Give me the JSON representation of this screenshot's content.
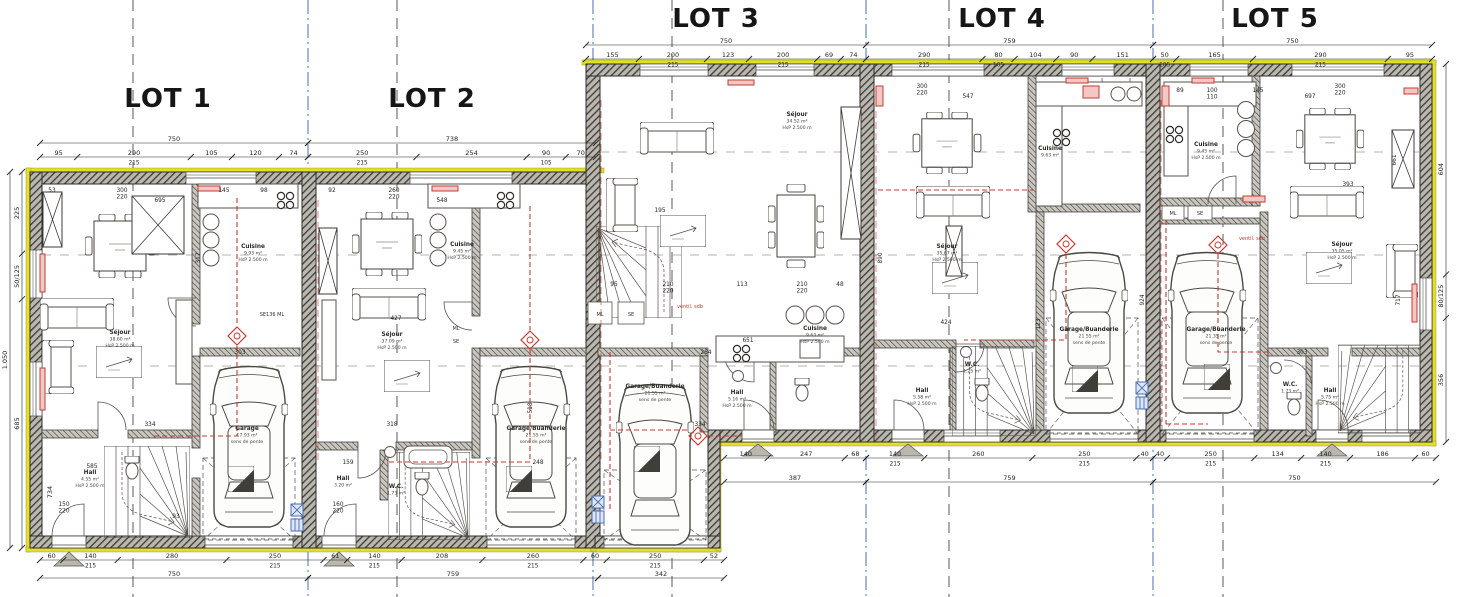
{
  "lot_titles": [
    "LOT 1",
    "LOT 2",
    "LOT 3",
    "LOT 4",
    "LOT 5"
  ],
  "rooms": {
    "l1_sejour": [
      "Séjour",
      "38.60 m²",
      "HsP 2.500 m"
    ],
    "l1_cuisine": [
      "Cuisine",
      "9.93 m²",
      "HsP 2.500 m"
    ],
    "l1_garage": [
      "Garage",
      "17.93 m²",
      "sens de pente"
    ],
    "l1_hall": [
      "Hall",
      "4.55 m²",
      "HsP 2.500 m"
    ],
    "l2_sejour": [
      "Séjour",
      "37.09 m²",
      "HsP 2.500 m"
    ],
    "l2_cuisine": [
      "Cuisine",
      "9.45 m²",
      "HsP 2.500 m"
    ],
    "l2_garage": [
      "Garage/Buanderie",
      "21.55 m²",
      "sens de pente"
    ],
    "l2_hall": [
      "Hall",
      "3.20 m²"
    ],
    "l2_wc": [
      "W.C.",
      "1.73 m²"
    ],
    "l3_sejour": [
      "Séjour",
      "34.52 m²",
      "HsP 2.500 m"
    ],
    "l3_cuisine": [
      "Cuisine",
      "9.63 m²",
      "HsP 2.500 m"
    ],
    "l3_garage": [
      "Garage/Buanderie",
      "21.55 m²",
      "sens de pente"
    ],
    "l3_hall": [
      "Hall",
      "5.16 m²",
      "HsP 2.500 m"
    ],
    "l4_sejour": [
      "Séjour",
      "35.67 m²",
      "HsP 2.500 m"
    ],
    "l4_cuisine": [
      "Cuisine",
      "9.63 m²"
    ],
    "l4_garage": [
      "Garage/Buanderie",
      "21.55 m²",
      "sens de pente"
    ],
    "l4_hall": [
      "Hall",
      "5.58 m²",
      "HsP 2.500 m"
    ],
    "l4_wc": [
      "W.C.",
      "1.25 m²"
    ],
    "l5_sejour": [
      "Séjour",
      "35.05 m²",
      "HsP 2.500 m"
    ],
    "l5_cuisine": [
      "Cuisine",
      "9.45 m²",
      "HsP 2.500 m"
    ],
    "l5_garage": [
      "Garage/Buanderie",
      "21.35 m²",
      "sens de pente"
    ],
    "l5_hall": [
      "Hall",
      "5.75 m²",
      "HsP 2.500 m"
    ],
    "l5_wc": [
      "W.C.",
      "1.73 m²"
    ]
  },
  "tags": {
    "l1_se": "SE136  ML",
    "l2_ml": "ML",
    "l2_se": "SE",
    "l3_ml": "ML",
    "l3_se": "SE",
    "l3_ventil": "ventil. sdb",
    "l5_ml": "ML",
    "l5_se": "SE",
    "l5_ventil": "ventil. sdb"
  },
  "dims": {
    "top_a_total": [
      "750",
      "738"
    ],
    "top_a_parts_1": [
      "95",
      "290/215",
      "105",
      "120",
      "74"
    ],
    "top_a_parts_2": [
      "250/215",
      "254",
      "90/105",
      "70"
    ],
    "top_b_total": [
      "750",
      "759",
      "750"
    ],
    "top_b_parts_3": [
      "155",
      "200/215",
      "123",
      "200/215",
      "69",
      "74"
    ],
    "top_b_parts_4": [
      "290/215",
      "80/105",
      "104",
      "90",
      "151"
    ],
    "top_b_parts_5": [
      "50/105",
      "165",
      "290/215",
      "95"
    ],
    "bottom_a_parts": [
      "60",
      "140/215",
      "280",
      "250/215",
      "61",
      "140/215",
      "208",
      "260/215",
      "60",
      "250/215",
      "52"
    ],
    "bottom_a_total": [
      "750",
      "759",
      "342"
    ],
    "bottom_b_parts_3": [
      "140",
      "247",
      "68"
    ],
    "bottom_b_parts_4": [
      "140/215",
      "260",
      "250/215",
      "40"
    ],
    "bottom_b_parts_5": [
      "40",
      "250/215",
      "134",
      "140/215",
      "186",
      "60"
    ],
    "bottom_b_total": [
      "387",
      "759",
      "750"
    ],
    "left": [
      "225",
      "50/125",
      "685"
    ],
    "left_total": "1.050",
    "left_inner": "734",
    "right": [
      "604",
      "80/125",
      "356"
    ],
    "interior": {
      "i1": "53",
      "i2": "300/220",
      "i3": "695",
      "i4": "145",
      "i5": "98",
      "i6": "317",
      "i7": "334",
      "i8": "585",
      "i9": "150/220",
      "i10": "93",
      "i11": "303",
      "i12": "92",
      "i13": "260/220",
      "i14": "548",
      "i15": "427",
      "i16": "318",
      "i17": "159",
      "i18": "160/220",
      "i19": "518",
      "i20": "248",
      "i21": "95",
      "i22": "210/220",
      "i23": "113",
      "i24": "210/220",
      "i25": "48",
      "i26": "651",
      "i27": "334",
      "i28": "195",
      "i29": "264",
      "i30": "300/220",
      "i31": "547",
      "i32": "424",
      "i33": "123",
      "i34": "924",
      "i35": "890",
      "i36": "89",
      "i37": "100/110",
      "i38": "145",
      "i39": "300/220",
      "i40": "697",
      "i41": "661",
      "i42": "717",
      "i43": "303",
      "i44": "393"
    }
  },
  "colors": {
    "insulation": "#e3de2a",
    "wall": "#b9b7ae",
    "wall_line": "#3c3b36",
    "heating": "#c43b34",
    "boundary_axis": "#4a6fb5",
    "axis": "#5a5a55",
    "furniture": "#55534c"
  }
}
